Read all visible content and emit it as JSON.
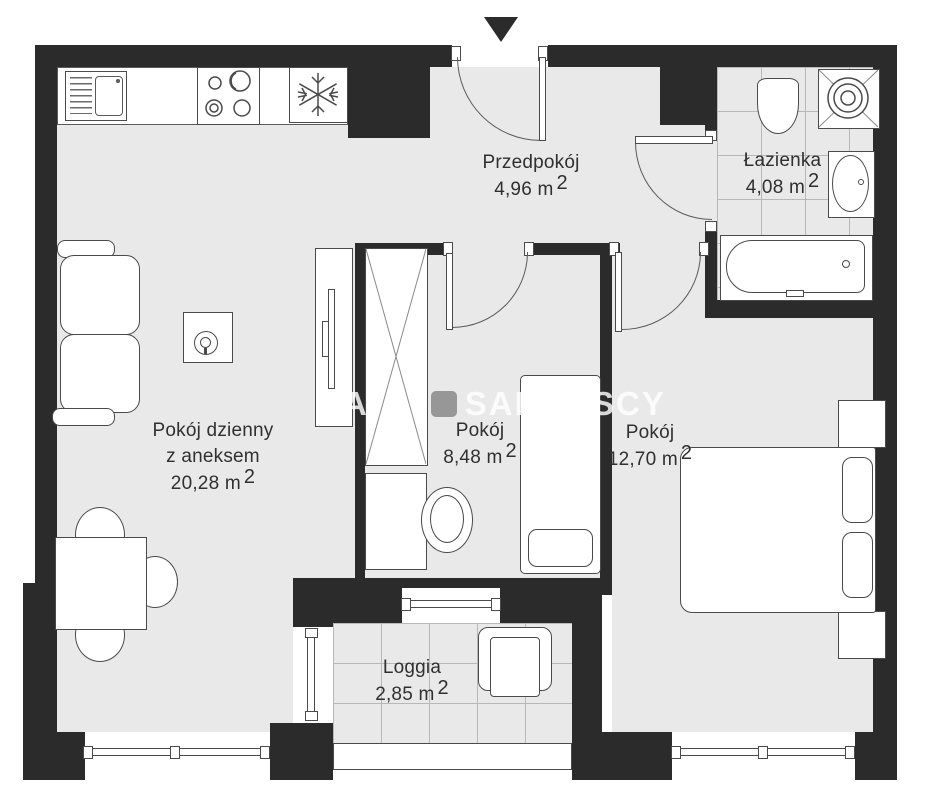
{
  "plan": {
    "type": "apartment-floor-plan",
    "language": "Polish",
    "watermark": {
      "letter1": "A",
      "letter2": "A",
      "brand": "SADURSCY"
    },
    "colors": {
      "wall": "#2b2b2b",
      "floor": "#e9e9e9",
      "furniture_line": "#4a4a4a",
      "tile_line": "#b8b8b8",
      "text": "#303030"
    }
  },
  "rooms": [
    {
      "id": "living",
      "name": "Pokój dzienny",
      "name2": "z aneksem",
      "area": "20,28 m",
      "sup": "2"
    },
    {
      "id": "hall",
      "name": "Przedpokój",
      "area": "4,96 m",
      "sup": "2"
    },
    {
      "id": "bath",
      "name": "Łazienka",
      "area": "4,08 m",
      "sup": "2"
    },
    {
      "id": "room",
      "name": "Pokój",
      "area": "8,48 m",
      "sup": "2"
    },
    {
      "id": "bedroom",
      "name": "Pokój",
      "area": "12,70 m",
      "sup": "2"
    },
    {
      "id": "loggia",
      "name": "Loggia",
      "area": "2,85 m",
      "sup": "2"
    }
  ]
}
